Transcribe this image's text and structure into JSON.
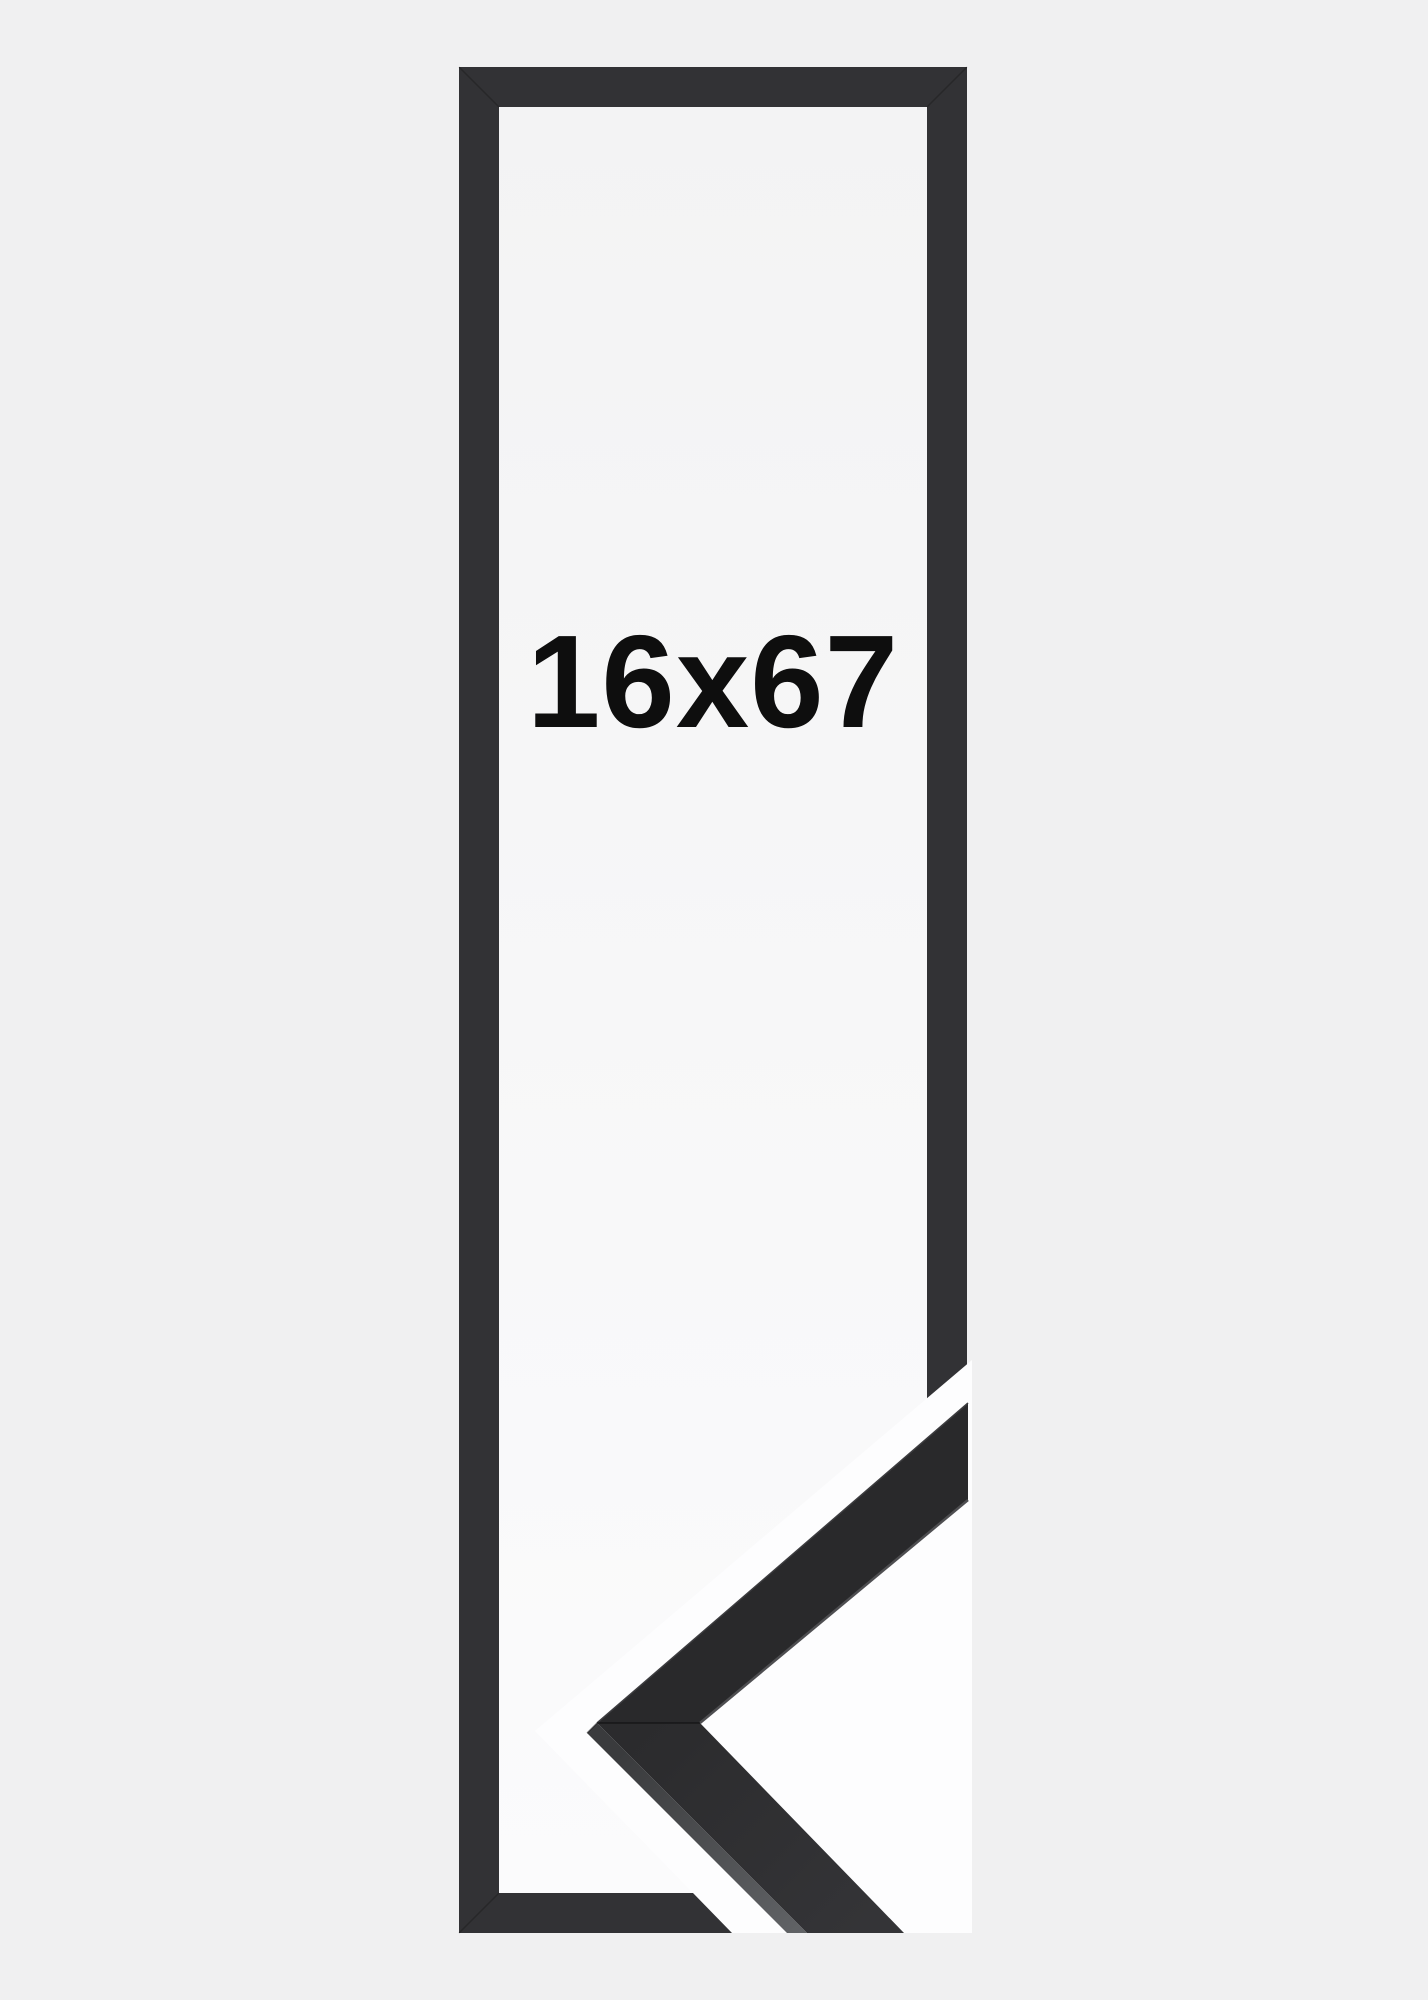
{
  "image": {
    "size_label": "16x67",
    "colors": {
      "background": "#f0f0f1",
      "frame": "#323235",
      "interior_top": "#f3f3f4",
      "interior_bottom": "#fbfbfc",
      "sample_backdrop_white": "#fdfdfe",
      "moulding_upper_face": "#29292b",
      "moulding_lower_face_start": "#2b2b2d",
      "moulding_lower_face_end": "#343437",
      "moulding_side_dark": "#3a3b3d",
      "moulding_side_light": "#616366",
      "label_text": "#0e0e0e"
    }
  }
}
